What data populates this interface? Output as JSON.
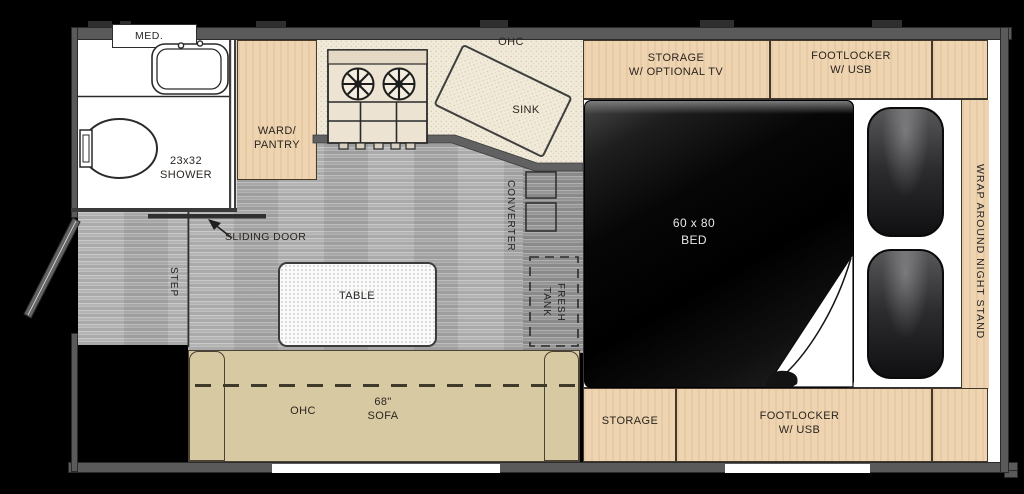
{
  "floorplan": {
    "bathroom": {
      "med_cabinet": "MED.",
      "shower": "23x32\nSHOWER"
    },
    "wardrobe": {
      "label": "WARD/\nPANTRY"
    },
    "kitchen": {
      "overhead_cabinet": "OHC",
      "sink": "SINK"
    },
    "entry": {
      "sliding_door": "SLIDING DOOR",
      "step": "STEP"
    },
    "utilities": {
      "converter": "CONVERTER",
      "fresh_tank": "FRESH\nTANK"
    },
    "dinette": {
      "table": "TABLE",
      "sofa_overhead_cabinet": "OHC",
      "sofa": "68\"\nSOFA"
    },
    "bedroom": {
      "bed": "60 x 80\nBED",
      "storage_tv": "STORAGE\nW/ OPTIONAL TV",
      "footlocker_top": "FOOTLOCKER\nW/ USB",
      "storage_bottom": "STORAGE",
      "footlocker_bottom": "FOOTLOCKER\nW/ USB",
      "night_stand": "WRAP AROUND NIGHT STAND"
    },
    "colors": {
      "wood": "#eed4b0",
      "sofa": "#d7c9a2",
      "floor": "#b4b4b4",
      "floor_dark": "#9d9d9d",
      "wall": "#5a5a5a",
      "counter": "#f1ead9",
      "bed": "#050505"
    }
  }
}
